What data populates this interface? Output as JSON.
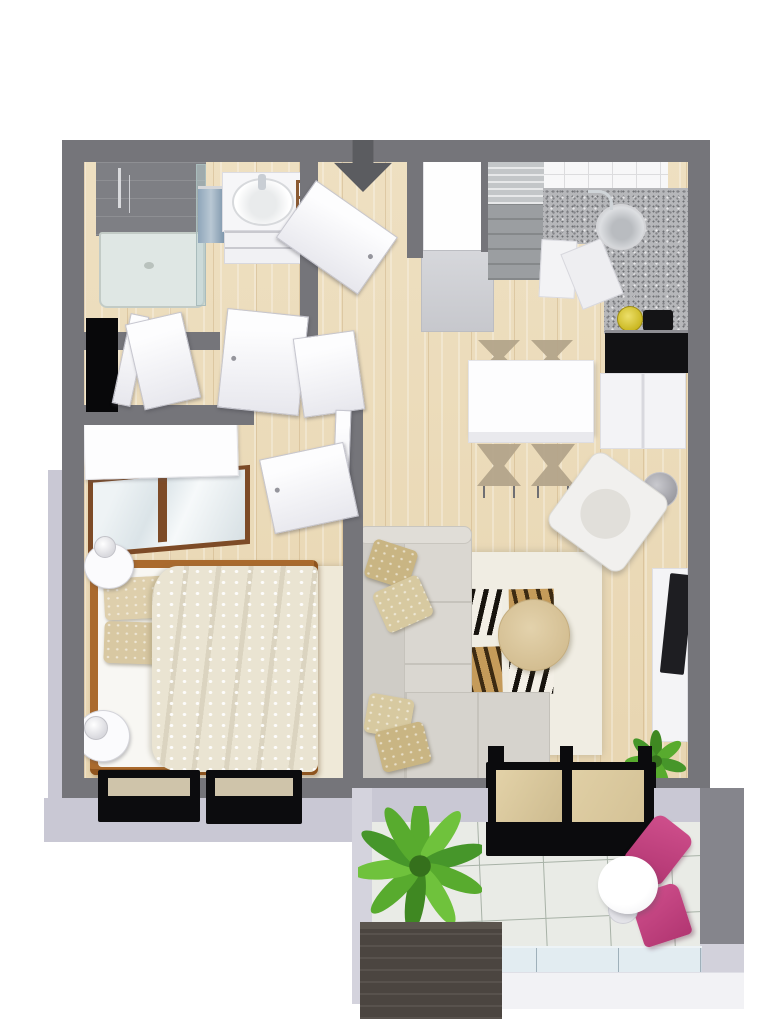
{
  "scene": {
    "type": "3d-apartment-floorplan",
    "view": "top-down isometric render",
    "background": "#ffffff",
    "entrance_marker": "dark gray arrow pointing down into entry door"
  },
  "palette": {
    "wall_top": "#75757a",
    "wall_outer_face": "#c9c8d4",
    "floor_wood": "#ecdcba",
    "bath_tile": "#7e7f84",
    "granite_counter": "#b6b7ba",
    "backsplash_tile": "#f7f7f8",
    "balcony_tile": "#e9ebe6",
    "sofa": "#d6d3cd",
    "pillow_tan": "#c9b583",
    "rug": "#f0ede3",
    "coffee_table_wood": "#d8c49c",
    "bed_frame_wood": "#aa6a2d",
    "duvet": "#eae4d2",
    "window_door_frame": "#0c0c0e",
    "accent_pink_chairs": "#c2417f",
    "plant_green": "#58ab2e",
    "kettle_yellow": "#d8c631",
    "arrow_gray": "#5b5c60"
  },
  "rooms": [
    {
      "name": "bathroom",
      "furniture": [
        "corner-shower with glass enclosure",
        "shower-tray",
        "towel-rail with towels",
        "vanity-cabinet with basin and faucet",
        "wooden-towel-ladder"
      ]
    },
    {
      "name": "entry-hallway",
      "furniture": [
        "entry-door (open)",
        "entrance-arrow",
        "tall-white-cabinet",
        "closet-bifold-doors",
        "dark-closet-niche",
        "bathroom-door (open)",
        "hall-door (open)"
      ]
    },
    {
      "name": "kitchen",
      "furniture": [
        "striped-gray-cabinet",
        "white-backsplash-tiles",
        "granite-L-countertop",
        "round-sink with faucet",
        "corner-base-cabinets",
        "cooktop",
        "yellow-kettle",
        "black-counter-front"
      ]
    },
    {
      "name": "dining-area",
      "furniture": [
        "white-dining-table",
        "four-chairs",
        "white-sideboard"
      ]
    },
    {
      "name": "living-room",
      "furniture": [
        "corner-sofa",
        "four-throw-pillows",
        "white-area-rug",
        "four-zebra-print-panels",
        "round-wood-coffee-table",
        "white-armchair",
        "floor-lamp",
        "tv-lowboard",
        "flat-tv",
        "potted-plant"
      ]
    },
    {
      "name": "bedroom",
      "furniture": [
        "wardrobe with wood-framed sliding doors",
        "double-bed with wood frame",
        "patterned-duvet",
        "two-pillows",
        "two-round-nightstands",
        "two-table-lamps",
        "beige-rug",
        "two-black-framed-windows",
        "bedroom-door (open)"
      ]
    },
    {
      "name": "balcony",
      "furniture": [
        "black-sliding-glass-door",
        "palm-plant",
        "dark-wood-storage-box",
        "round-bistro-table",
        "two-pink-chairs",
        "glass-railing"
      ]
    }
  ]
}
